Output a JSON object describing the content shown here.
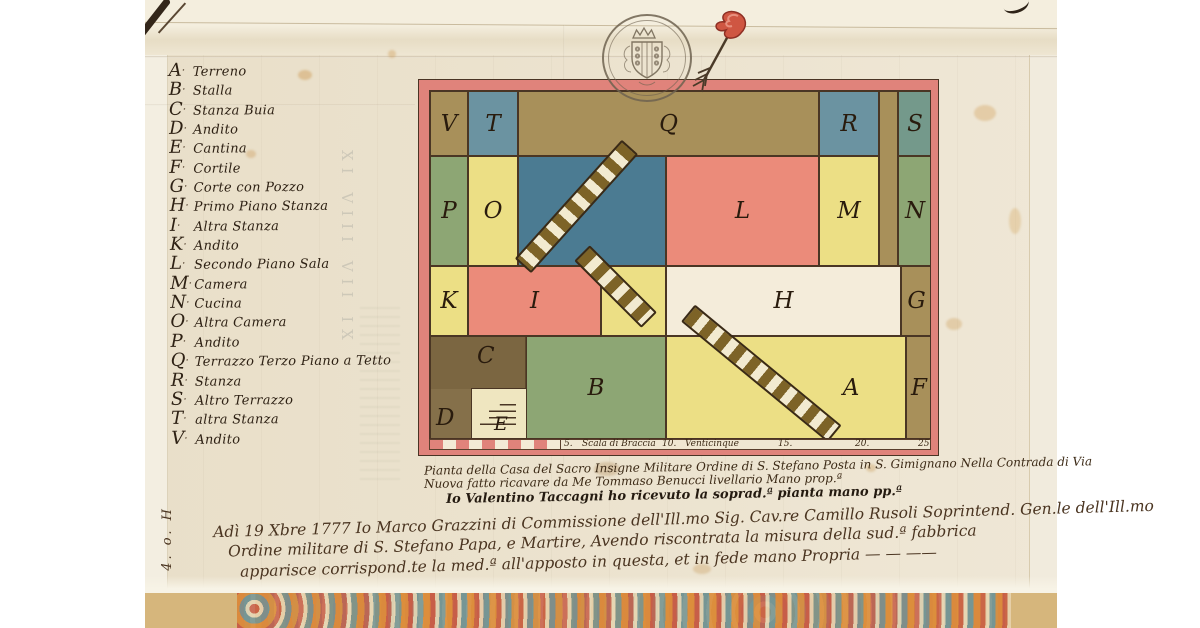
{
  "palette": {
    "tan": "#a8905a",
    "blue": "#6b93a1",
    "stairblue": "#4b7b92",
    "teal": "#74998b",
    "green": "#8da674",
    "yellow": "#ecdf85",
    "paleyellow": "#efe6c0",
    "pink": "#eb8b7a",
    "cream": "#f4ecda",
    "brown": "#85704a",
    "darkbrown": "#6e5a37",
    "border_red": "#e0837b",
    "ink": "#3a2a1a"
  },
  "icons": {
    "seal": "coat-of-arms-seal",
    "pennant": "red-pennant-arrow",
    "staircase": "staircase-hatch",
    "steps": "corner-steps"
  },
  "legend": {
    "items": [
      {
        "letter": "A",
        "name": "Terreno"
      },
      {
        "letter": "B",
        "name": "Stalla"
      },
      {
        "letter": "C",
        "name": "Stanza Buia"
      },
      {
        "letter": "D",
        "name": "Andito"
      },
      {
        "letter": "E",
        "name": "Cantina"
      },
      {
        "letter": "F",
        "name": "Cortile"
      },
      {
        "letter": "G",
        "name": "Corte con Pozzo"
      },
      {
        "letter": "H",
        "name": "Primo Piano Stanza"
      },
      {
        "letter": "I",
        "name": "Altra Stanza"
      },
      {
        "letter": "K",
        "name": "Andito"
      },
      {
        "letter": "L",
        "name": "Secondo Piano Sala"
      },
      {
        "letter": "M",
        "name": "Camera"
      },
      {
        "letter": "N",
        "name": "Cucina"
      },
      {
        "letter": "O",
        "name": "Altra Camera"
      },
      {
        "letter": "P",
        "name": "Andito"
      },
      {
        "letter": "Q",
        "name": "Terrazzo Terzo Piano a Tetto"
      },
      {
        "letter": "R",
        "name": "Stanza"
      },
      {
        "letter": "S",
        "name": "Altro Terrazzo"
      },
      {
        "letter": "T",
        "name": "altra Stanza"
      },
      {
        "letter": "V",
        "name": "Andito"
      }
    ]
  },
  "plan": {
    "rooms": [
      {
        "letter": "V"
      },
      {
        "letter": "T"
      },
      {
        "letter": "Q"
      },
      {
        "letter": "R"
      },
      {
        "letter": "S"
      },
      {
        "letter": "P"
      },
      {
        "letter": "O"
      },
      {
        "letter": "L"
      },
      {
        "letter": "M"
      },
      {
        "letter": "N"
      },
      {
        "letter": "K"
      },
      {
        "letter": "I"
      },
      {
        "letter": "H"
      },
      {
        "letter": "G"
      },
      {
        "letter": "C"
      },
      {
        "letter": "D"
      },
      {
        "letter": "E"
      },
      {
        "letter": "B"
      },
      {
        "letter": "A"
      },
      {
        "letter": "F"
      }
    ],
    "scale_labels": [
      "5.",
      "Scala di Braccia",
      "10.",
      "Venticinque",
      "15.",
      "20.",
      "25"
    ]
  },
  "captions": [
    "Pianta della Casa del Sacro Insigne Militare Ordine di S. Stefano Posta in S. Gimignano Nella Contrada di Via",
    "Nuova fatto ricavare da Me Tommaso Benucci livellario Mano prop.ª",
    "Io Valentino Taccagni ho ricevuto la soprad.ª pianta mano pp.ª"
  ],
  "docket": [
    "Adì 19 Xbre 1777 Io Marco Grazzini di Commissione dell'Ill.mo Sig. Cav.re Camillo Rusoli Soprintend. Gen.le dell'Ill.mo",
    "Ordine militare di S. Stefano Papa, e Martire, Avendo riscontrata la misura della sud.ª fabbrica",
    "apparisce corrispond.te la med.ª all'apposto in questa, et in fede mano Propria  —  —  ——"
  ],
  "margin_mark": "4. o. H",
  "ghost_numerals": "XI VIII VII IX"
}
